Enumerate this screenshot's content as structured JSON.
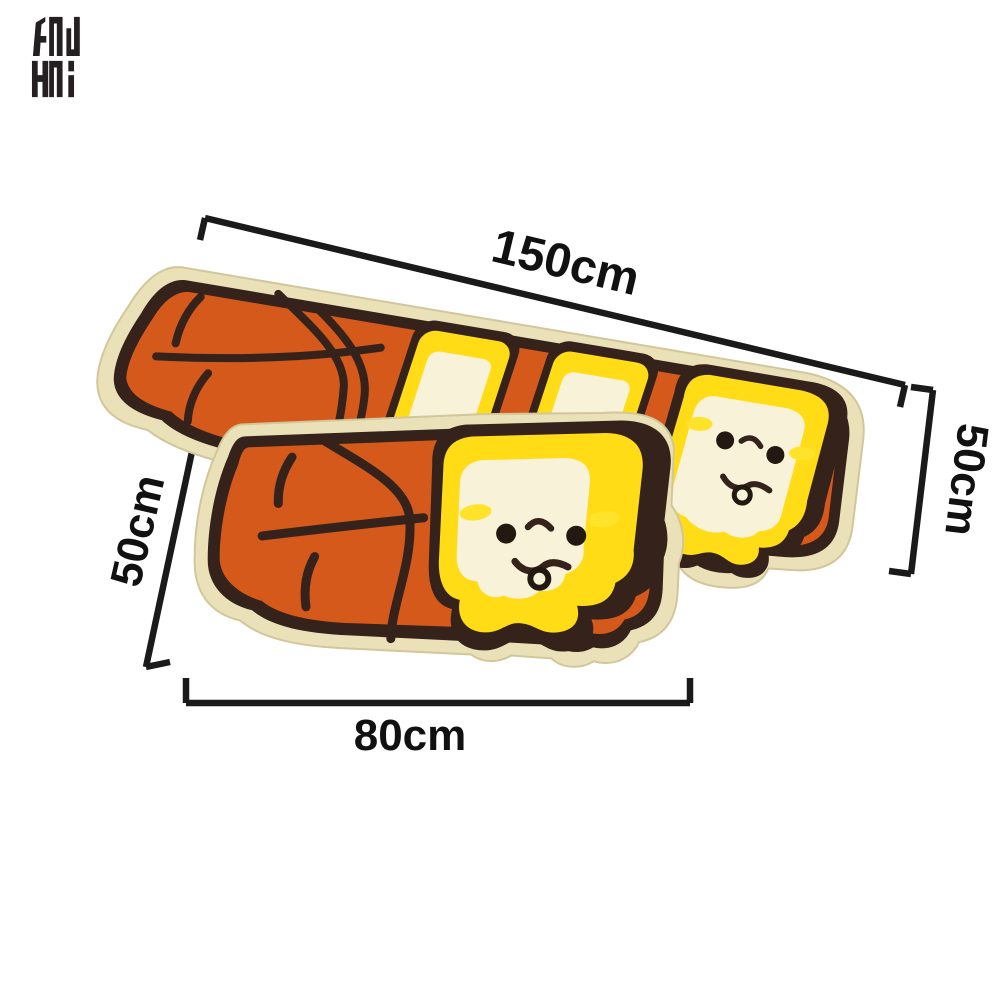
{
  "page": {
    "background": "#ffffff",
    "description": "Product dimension diagram of two toast-loaf shaped floor mats with cartoon faces"
  },
  "logo": {
    "name": "brand-monogram",
    "rows": [
      "GNU",
      "HNI"
    ],
    "color": "#242021"
  },
  "product": {
    "mats": [
      {
        "id": "large-mat",
        "length_label": "150cm",
        "height_label": "50cm"
      },
      {
        "id": "small-mat",
        "length_label": "80cm",
        "height_label": "50cm"
      }
    ]
  },
  "annotations": {
    "top_length": {
      "label": "150cm"
    },
    "right_height": {
      "label": "50cm"
    },
    "left_height": {
      "label": "50cm"
    },
    "bottom_length": {
      "label": "80cm"
    },
    "line_color": "#1a1a1a",
    "text_color": "#111111"
  },
  "colors": {
    "mat_border_beige": "#EBE1B8",
    "mat_border_edge": "#D2C69B",
    "outline_dark": "#35221A",
    "loaf_orange": "#D4591B",
    "toast_yellow": "#FFDC15",
    "toast_cream": "#F8F3D8",
    "cheek_yellow": "#FFE32B",
    "logo_black": "#242021"
  }
}
